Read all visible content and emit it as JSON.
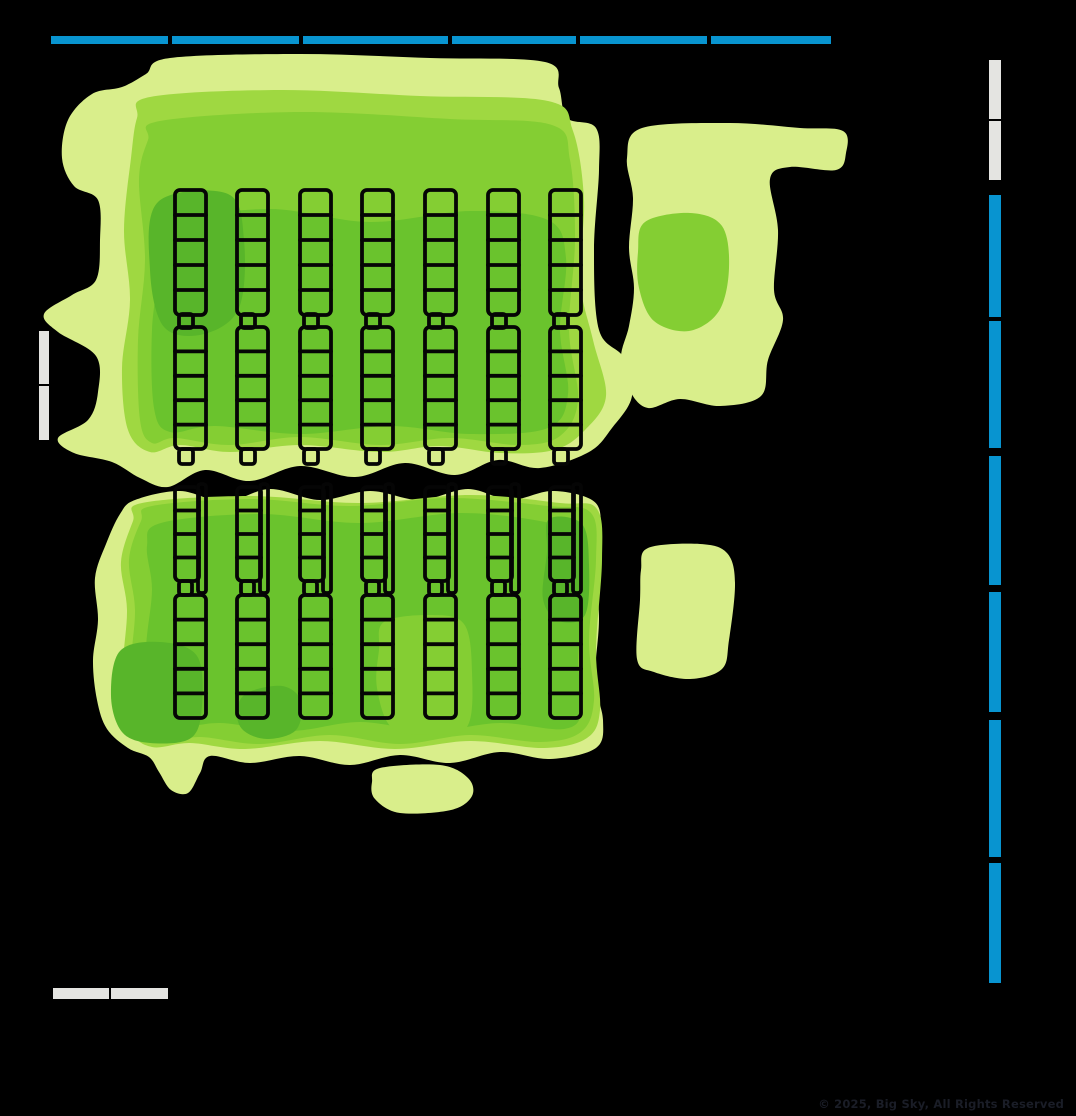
{
  "canvas": {
    "width": 1076,
    "height": 1116,
    "background": "#000000"
  },
  "copyright": "© 2025, Big Sky, All Rights Reserved",
  "colors": {
    "background": "#000000",
    "fixture_blue": "#0894d0",
    "wall_gray": "#e4e4e1",
    "outline": "#050505",
    "copyright_text": "#1a1d27",
    "heat": {
      "l1": "#d9ee8b",
      "l2": "#9fd841",
      "l3": "#84ce33",
      "l4": "#6ac32d",
      "l5": "#58b52a"
    }
  },
  "chart_data": {
    "type": "heatmap",
    "title": "",
    "subtitle": "",
    "legend_position": "none",
    "description": "Store floor-plan footfall/dwell heatmap drawn over shelf fixtures; density shading from light yellow-green (low) to deep green (high) on a black background.",
    "heat_levels": [
      {
        "rank": 1,
        "color": "#d9ee8b",
        "label": "low"
      },
      {
        "rank": 2,
        "color": "#9fd841",
        "label": "medium-low"
      },
      {
        "rank": 3,
        "color": "#84ce33",
        "label": "medium"
      },
      {
        "rank": 4,
        "color": "#6ac32d",
        "label": "high"
      },
      {
        "rank": 5,
        "color": "#58b52a",
        "label": "very high"
      }
    ],
    "fixtures": {
      "top_wall_shelves": {
        "y": 36,
        "height": 8,
        "color_key": "fixture_blue",
        "segments": [
          {
            "x": 51,
            "w": 117
          },
          {
            "x": 172,
            "w": 127
          },
          {
            "x": 303,
            "w": 145
          },
          {
            "x": 452,
            "w": 124
          },
          {
            "x": 580,
            "w": 127
          },
          {
            "x": 711,
            "w": 120
          }
        ]
      },
      "right_wall_shelves": {
        "x": 989,
        "width": 12,
        "segments": [
          {
            "y": 60,
            "h": 59,
            "color_key": "wall_gray"
          },
          {
            "y": 121,
            "h": 59,
            "color_key": "wall_gray"
          },
          {
            "y": 195,
            "h": 122,
            "color_key": "fixture_blue"
          },
          {
            "y": 321,
            "h": 127,
            "color_key": "fixture_blue"
          },
          {
            "y": 456,
            "h": 129,
            "color_key": "fixture_blue"
          },
          {
            "y": 592,
            "h": 120,
            "color_key": "fixture_blue"
          },
          {
            "y": 720,
            "h": 137,
            "color_key": "fixture_blue"
          },
          {
            "y": 863,
            "h": 120,
            "color_key": "fixture_blue"
          }
        ]
      },
      "left_wall_door": {
        "x": 39,
        "width": 10,
        "color_key": "wall_gray",
        "segments": [
          {
            "y": 331,
            "h": 53
          },
          {
            "y": 386,
            "h": 54
          }
        ]
      },
      "bottom_wall_door": {
        "y": 988,
        "height": 11,
        "color_key": "wall_gray",
        "segments": [
          {
            "x": 53,
            "w": 56
          },
          {
            "x": 111,
            "w": 57
          }
        ]
      },
      "gondola_blocks": [
        {
          "name": "upper-block",
          "columns": 7,
          "col_x": [
            175,
            237,
            300,
            362,
            425,
            488,
            550
          ],
          "col_width": 31,
          "units": [
            {
              "y": 190,
              "h": 125,
              "cells": 5
            },
            {
              "y": 327,
              "h": 122,
              "cells": 5
            }
          ],
          "neck": {
            "x_off": 4,
            "w": 14,
            "y": 314,
            "h": 14
          },
          "foot": {
            "x_off": 4,
            "w": 14,
            "y": 449,
            "h": 15
          }
        },
        {
          "name": "lower-block",
          "columns": 7,
          "col_x": [
            175,
            237,
            300,
            362,
            425,
            488,
            550
          ],
          "col_width": 31,
          "units": [
            {
              "y": 487,
              "h": 94,
              "cells": 4,
              "w": 24,
              "rail": {
                "x_off": 23,
                "w": 8,
                "y": 484,
                "h": 109
              }
            },
            {
              "y": 595,
              "h": 123,
              "cells": 5
            }
          ],
          "neck": {
            "x_off": 4,
            "w": 13,
            "y": 581,
            "h": 14
          }
        }
      ]
    }
  }
}
